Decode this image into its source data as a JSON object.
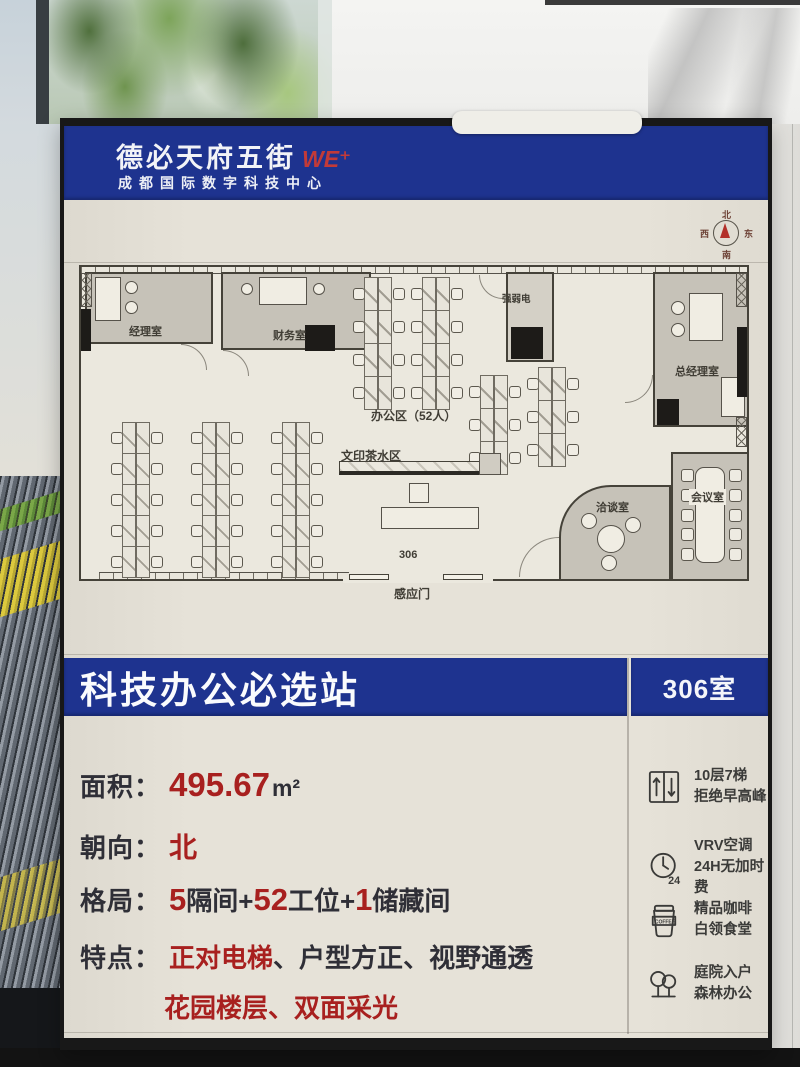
{
  "poster": {
    "header": {
      "brand": "德必天府五街",
      "brand_suffix": "WE⁺",
      "subtitle": "成都国际数字科技中心"
    },
    "compass": {
      "north": "北",
      "south": "南",
      "east": "东",
      "west": "西"
    },
    "plan": {
      "rooms": {
        "manager": "经理室",
        "finance": "财务室",
        "electrical": "强弱电",
        "general_manager": "总经理室",
        "negotiation": "洽谈室",
        "meeting": "会议室"
      },
      "labels": {
        "office_area": "办公区（52人）",
        "print_tea": "文印茶水区",
        "room_number": "306",
        "sensor_door": "感应门"
      }
    },
    "banner": {
      "title": "科技办公必选站",
      "room": "306室"
    },
    "details": {
      "area": {
        "label": "面积：",
        "value": "495.67",
        "unit": "m²"
      },
      "orientation": {
        "label": "朝向：",
        "value": "北"
      },
      "layout": {
        "label": "格局：",
        "parts": [
          "5",
          "隔间+",
          "52",
          "工位+",
          "1",
          "储藏间"
        ]
      },
      "features": {
        "label": "特点：",
        "f1": "正对电梯",
        "s1": "、",
        "f2": "户型方正",
        "s2": "、",
        "f3": "视野通透",
        "f4": "花园楼层",
        "s3": "、",
        "f5": "双面采光"
      }
    },
    "amenities": [
      {
        "icon": "elevator-icon",
        "line1": "10层7梯",
        "line2": "拒绝早高峰"
      },
      {
        "icon": "clock-24-icon",
        "line1": "VRV空调",
        "line2": "24H无加时费",
        "badge": "24"
      },
      {
        "icon": "coffee-icon",
        "line1": "精品咖啡",
        "line2": "白领食堂",
        "badge": "COFFEE"
      },
      {
        "icon": "trees-icon",
        "line1": "庭院入户",
        "line2": "森林办公"
      }
    ],
    "colors": {
      "blue": "#1e338f",
      "red": "#a8201f"
    }
  }
}
